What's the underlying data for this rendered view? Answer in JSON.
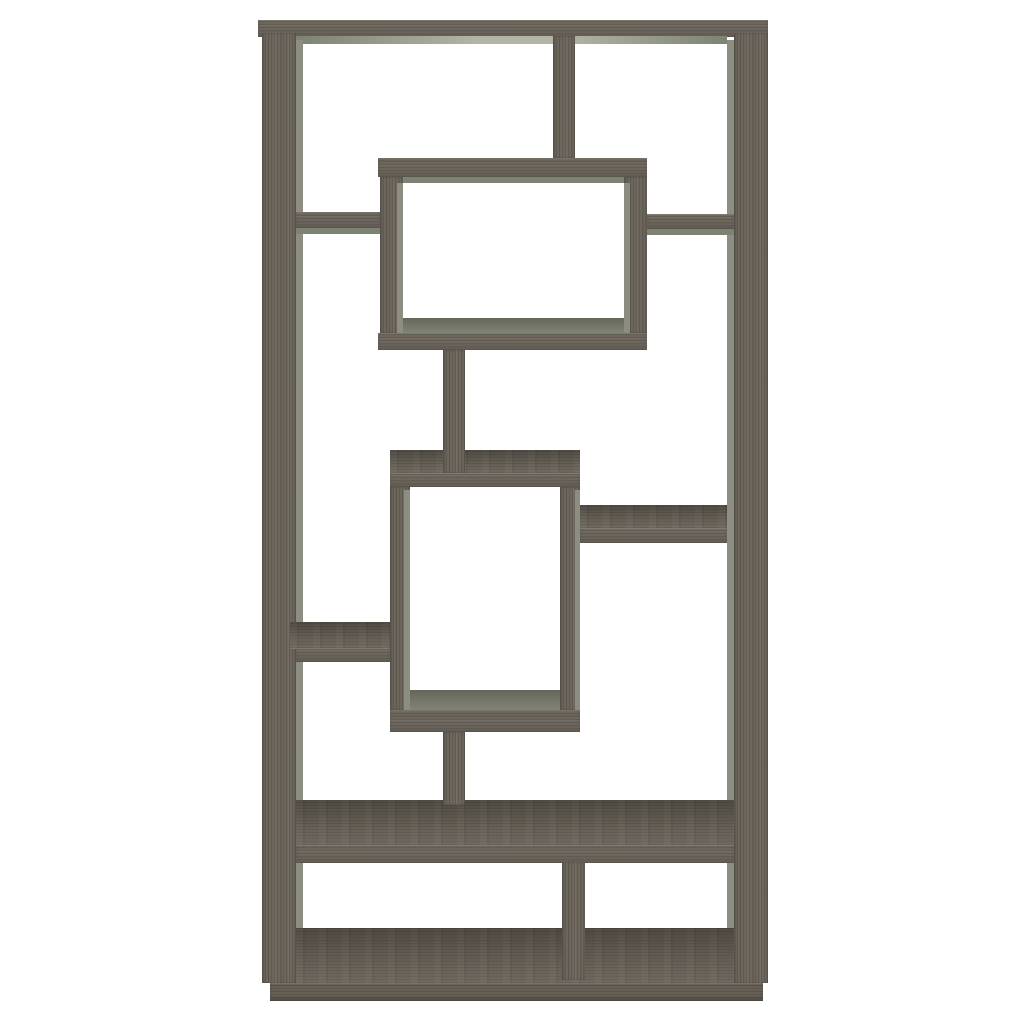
{
  "image_type": "product-photograph",
  "subject": "Ten-shelf asymmetrical geometric cube bookcase in weathered grey woodgrain finish, front view on plain white background",
  "visible_text": [],
  "palette": {
    "bg": "#ffffff",
    "wood": "#6c665d",
    "wood-top": "#676157",
    "wood-dark": "#655f55",
    "side": "#8b8e80",
    "inner": "#787a6c",
    "under-edge": "#7e8273",
    "under-center": "#b2b5a6"
  },
  "furniture": {
    "style": "interlocking rectangles with two offset display boxes, staggered shelves and full-width base",
    "parts": [
      {
        "name": "top-board",
        "x": 258,
        "y": 20,
        "w": 510,
        "h": 17,
        "finish": "wood-h"
      },
      {
        "name": "top-board-underside",
        "x": 296,
        "y": 36,
        "w": 431,
        "h": 8,
        "finish": "underside"
      },
      {
        "name": "left-upright",
        "x": 262,
        "y": 33,
        "w": 34,
        "h": 950,
        "finish": "wood-v"
      },
      {
        "name": "left-upright-inner-face",
        "x": 296,
        "y": 40,
        "w": 7,
        "h": 943,
        "finish": "side-face"
      },
      {
        "name": "right-upright",
        "x": 734,
        "y": 33,
        "w": 34,
        "h": 950,
        "finish": "wood-v"
      },
      {
        "name": "right-upright-inner-face",
        "x": 727,
        "y": 40,
        "w": 7,
        "h": 943,
        "finish": "side-face"
      },
      {
        "name": "top-divider",
        "x": 553,
        "y": 36,
        "w": 22,
        "h": 122,
        "finish": "wood-v"
      },
      {
        "name": "upper-left-shelf",
        "x": 296,
        "y": 212,
        "w": 84,
        "h": 16,
        "finish": "wood-h"
      },
      {
        "name": "upper-left-shelf-underside",
        "x": 296,
        "y": 228,
        "w": 84,
        "h": 6,
        "finish": "underside-flat"
      },
      {
        "name": "upper-right-shelf",
        "x": 647,
        "y": 214,
        "w": 87,
        "h": 15,
        "finish": "wood-h"
      },
      {
        "name": "upper-right-shelf-underside",
        "x": 647,
        "y": 229,
        "w": 87,
        "h": 6,
        "finish": "underside-flat"
      },
      {
        "name": "upper-box-top",
        "x": 378,
        "y": 158,
        "w": 269,
        "h": 19,
        "finish": "wood-h"
      },
      {
        "name": "upper-box-top-underside",
        "x": 403,
        "y": 177,
        "w": 221,
        "h": 6,
        "finish": "underside-flat"
      },
      {
        "name": "upper-box-left-wall",
        "x": 380,
        "y": 177,
        "w": 23,
        "h": 156,
        "finish": "wood-v"
      },
      {
        "name": "upper-box-left-wall-inner",
        "x": 397,
        "y": 183,
        "w": 6,
        "h": 150,
        "finish": "side-face"
      },
      {
        "name": "upper-box-right-wall",
        "x": 624,
        "y": 177,
        "w": 23,
        "h": 156,
        "finish": "wood-v"
      },
      {
        "name": "upper-box-right-wall-inner",
        "x": 624,
        "y": 183,
        "w": 6,
        "h": 150,
        "finish": "side-face"
      },
      {
        "name": "upper-box-floor",
        "x": 403,
        "y": 318,
        "w": 221,
        "h": 15,
        "finish": "inner-face"
      },
      {
        "name": "upper-box-bottom",
        "x": 378,
        "y": 333,
        "w": 269,
        "h": 17,
        "finish": "wood-h"
      },
      {
        "name": "middle-box-top-surface",
        "x": 390,
        "y": 450,
        "w": 190,
        "h": 23,
        "finish": "top-face"
      },
      {
        "name": "upper-stem",
        "x": 443,
        "y": 350,
        "w": 22,
        "h": 123,
        "finish": "wood-v"
      },
      {
        "name": "middle-box-top-edge",
        "x": 390,
        "y": 473,
        "w": 190,
        "h": 14,
        "finish": "wood-h"
      },
      {
        "name": "middle-box-left-wall",
        "x": 390,
        "y": 487,
        "w": 20,
        "h": 223,
        "finish": "wood-v"
      },
      {
        "name": "middle-box-left-wall-inner",
        "x": 404,
        "y": 490,
        "w": 6,
        "h": 220,
        "finish": "side-face"
      },
      {
        "name": "middle-box-right-wall",
        "x": 560,
        "y": 487,
        "w": 20,
        "h": 223,
        "finish": "wood-v"
      },
      {
        "name": "middle-box-right-wall-outer",
        "x": 575,
        "y": 490,
        "w": 5,
        "h": 220,
        "finish": "side-face"
      },
      {
        "name": "middle-box-floor",
        "x": 410,
        "y": 690,
        "w": 150,
        "h": 20,
        "finish": "inner-face"
      },
      {
        "name": "middle-box-bottom",
        "x": 390,
        "y": 710,
        "w": 190,
        "h": 22,
        "finish": "wood-h"
      },
      {
        "name": "middle-right-shelf-surface",
        "x": 580,
        "y": 505,
        "w": 147,
        "h": 23,
        "finish": "top-face"
      },
      {
        "name": "middle-right-shelf-edge",
        "x": 580,
        "y": 528,
        "w": 147,
        "h": 15,
        "finish": "wood-h"
      },
      {
        "name": "middle-left-shelf-surface",
        "x": 290,
        "y": 622,
        "w": 100,
        "h": 26,
        "finish": "top-face"
      },
      {
        "name": "middle-left-shelf-edge",
        "x": 296,
        "y": 648,
        "w": 94,
        "h": 14,
        "finish": "wood-h"
      },
      {
        "name": "big-shelf-surface",
        "x": 296,
        "y": 800,
        "w": 438,
        "h": 45,
        "finish": "top-face"
      },
      {
        "name": "lower-stem",
        "x": 443,
        "y": 732,
        "w": 22,
        "h": 73,
        "finish": "wood-v"
      },
      {
        "name": "big-shelf-edge",
        "x": 296,
        "y": 845,
        "w": 438,
        "h": 18,
        "finish": "wood-h"
      },
      {
        "name": "bottom-shelf-surface",
        "x": 296,
        "y": 928,
        "w": 438,
        "h": 55,
        "finish": "top-face"
      },
      {
        "name": "bottom-divider",
        "x": 562,
        "y": 862,
        "w": 23,
        "h": 118,
        "finish": "wood-v"
      },
      {
        "name": "base-board",
        "x": 270,
        "y": 983,
        "w": 493,
        "h": 18,
        "finish": "wood-h-dark"
      }
    ]
  }
}
